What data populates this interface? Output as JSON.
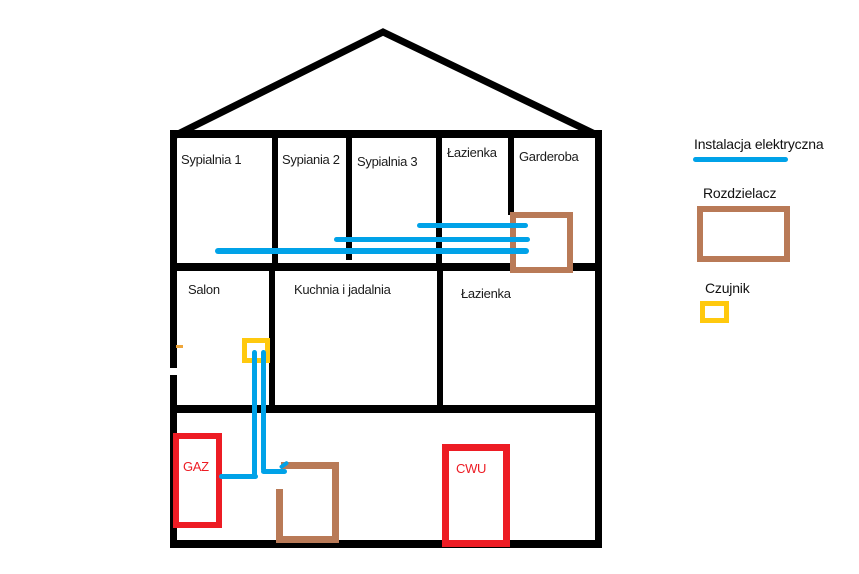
{
  "house": {
    "floor1_rooms": [
      "Sypialnia 1",
      "Sypiania 2",
      "Sypialnia 3",
      "Łazienka",
      "Garderoba"
    ],
    "floor2_rooms": [
      "Salon",
      "Kuchnia i jadalnia",
      "Łazienka"
    ],
    "basement_units": [
      "GAZ",
      "CWU"
    ]
  },
  "legend": {
    "electrical_label": "Instalacja elektryczna",
    "distributor_label": "Rozdzielacz",
    "sensor_label": "Czujnik"
  },
  "colors": {
    "electrical_blue": "#00A2E8",
    "distributor_brown": "#B97A57",
    "sensor_yellow": "#FFC90E",
    "unit_red": "#ED1C24",
    "wall_black": "#000000",
    "artifact_orange": "#EFA63B"
  }
}
